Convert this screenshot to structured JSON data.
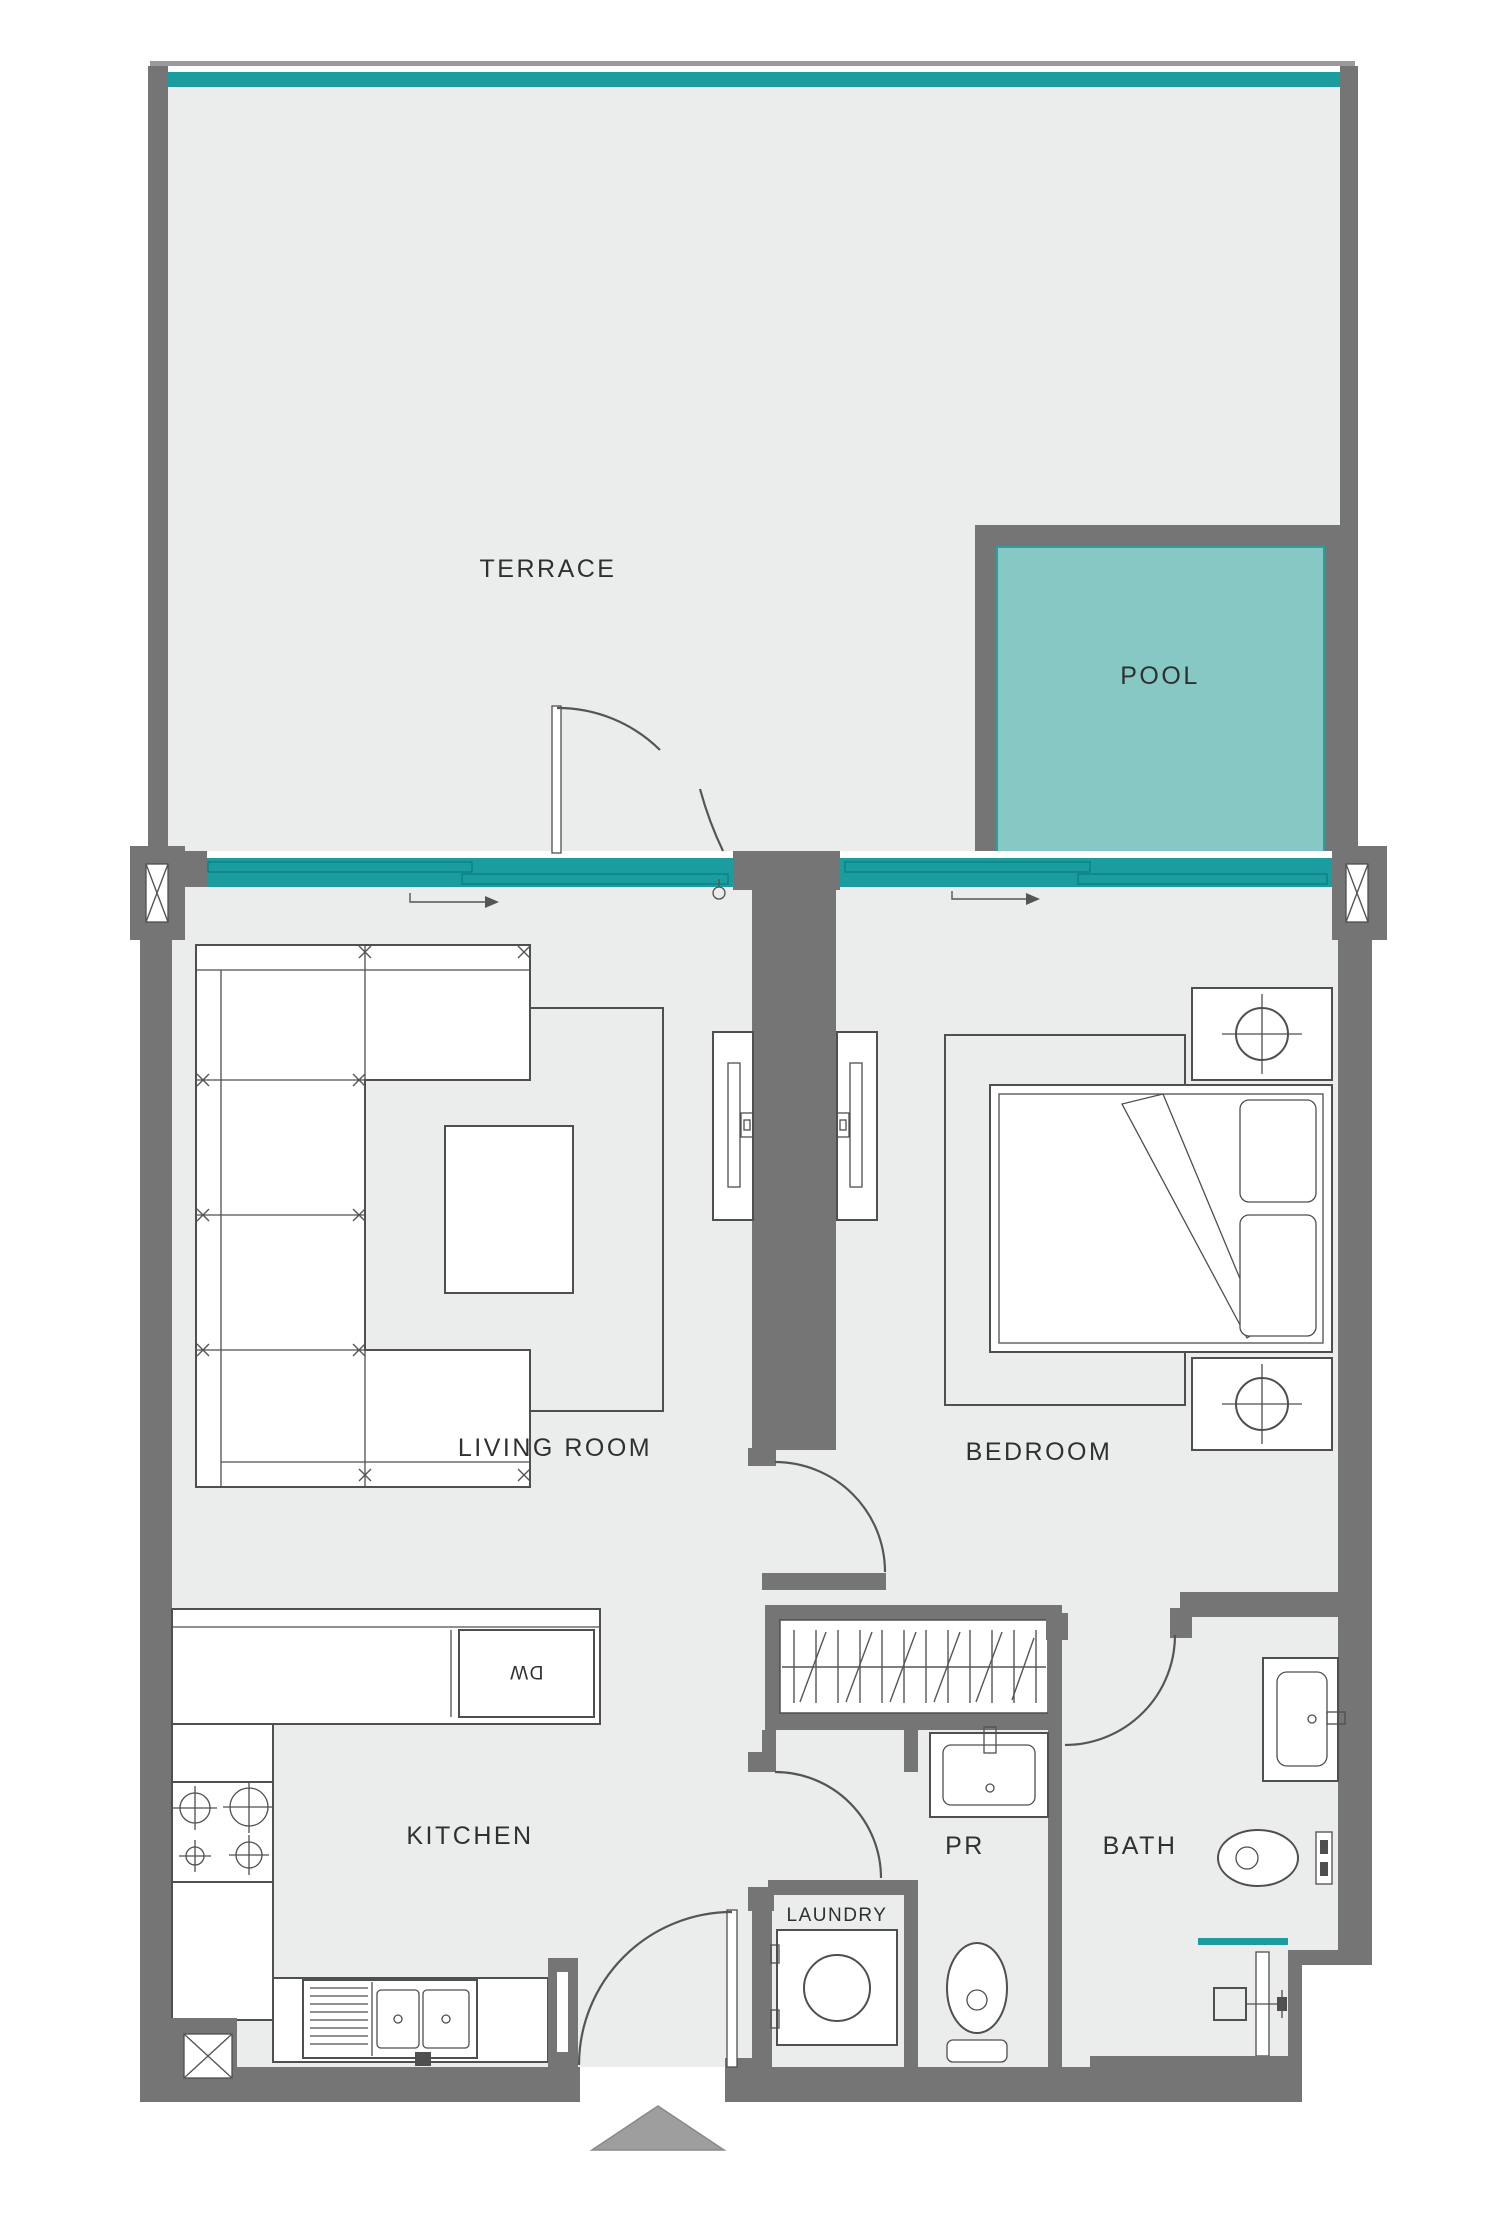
{
  "title": "Apartment Floor Plan",
  "rooms": {
    "terrace": "TERRACE",
    "pool": "POOL",
    "living_room": "LIVING ROOM",
    "bedroom": "BEDROOM",
    "kitchen": "KITCHEN",
    "powder_room": "PR",
    "bath": "BATH",
    "laundry": "LAUNDRY"
  },
  "appliances": {
    "dishwasher": "DW"
  },
  "colors": {
    "wall": "#757575",
    "floor": "#ebecec",
    "glass": "#1b9da0",
    "glass_dark": "#0e8184",
    "pool_water": "#85c8c4",
    "line": "#4f4f4f",
    "text": "#303030",
    "arrow_fill": "#9e9e9e"
  }
}
